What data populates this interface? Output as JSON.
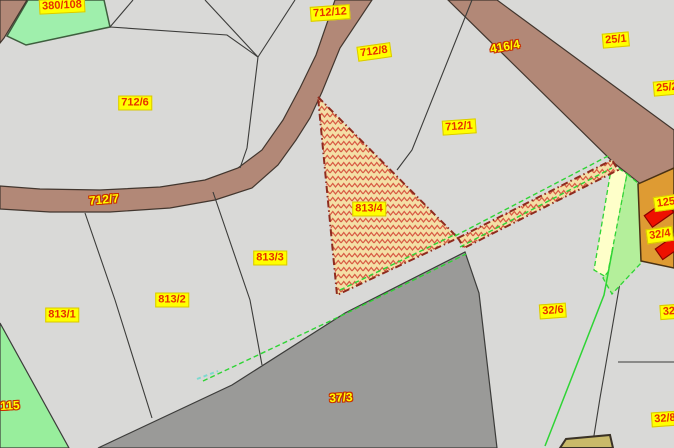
{
  "app": {
    "view": "cadastral-parcel-map"
  },
  "map": {
    "selected_parcel": "813/4",
    "colors": {
      "parcel_base": "#D9D9D7",
      "boundary_line": "#3C3C3A",
      "road_brown": "#B28877",
      "road_gray": "#9A9A98",
      "selection_fill": "#F4DFA6",
      "selection_hatch": "#D85C45",
      "selection_border": "#8F2B1E",
      "green_parcel": "#9FEFAC",
      "green_parcel_2": "#98EE9C",
      "light_green_parcel": "#B4EF9B",
      "pale_yellow_parcel": "#FEFFC9",
      "orange_parcel": "#DE9B33",
      "building_red": "#EE1100",
      "vegetation_green": "#2FD435",
      "water_dash_cyan": "#7ED9CF",
      "label_box_bg": "#FFFF00",
      "label_text_red": "#E63000",
      "label_text_yellow": "#FFFF00"
    },
    "labels": [
      {
        "text": "380/108",
        "x": 62,
        "y": 6,
        "style": "box",
        "rot": -3
      },
      {
        "text": "712/12",
        "x": 330,
        "y": 13,
        "style": "box",
        "rot": -4
      },
      {
        "text": "712/8",
        "x": 374,
        "y": 52,
        "style": "box",
        "rot": -8
      },
      {
        "text": "416/4",
        "x": 505,
        "y": 47,
        "style": "outline",
        "rot": -10
      },
      {
        "text": "25/1",
        "x": 616,
        "y": 40,
        "style": "box",
        "rot": -5
      },
      {
        "text": "25/2",
        "x": 667,
        "y": 88,
        "style": "box",
        "rot": -5
      },
      {
        "text": "712/6",
        "x": 135,
        "y": 103,
        "style": "box",
        "rot": 0
      },
      {
        "text": "712/1",
        "x": 459,
        "y": 127,
        "style": "box",
        "rot": -4
      },
      {
        "text": "712/7",
        "x": 104,
        "y": 200,
        "style": "outline",
        "rot": -5
      },
      {
        "text": "813/4",
        "x": 369,
        "y": 209,
        "style": "box",
        "rot": 0
      },
      {
        "text": "125",
        "x": 666,
        "y": 203,
        "style": "box",
        "rot": -8
      },
      {
        "text": "32/4",
        "x": 660,
        "y": 235,
        "style": "box",
        "rot": -8
      },
      {
        "text": "813/3",
        "x": 270,
        "y": 258,
        "style": "box",
        "rot": 0
      },
      {
        "text": "813/2",
        "x": 172,
        "y": 300,
        "style": "box",
        "rot": 0
      },
      {
        "text": "813/1",
        "x": 62,
        "y": 315,
        "style": "box",
        "rot": 0
      },
      {
        "text": "32/6",
        "x": 553,
        "y": 311,
        "style": "box",
        "rot": -4
      },
      {
        "text": "32",
        "x": 669,
        "y": 312,
        "style": "box",
        "rot": -4
      },
      {
        "text": "37/3",
        "x": 341,
        "y": 398,
        "style": "outline",
        "rot": -3
      },
      {
        "text": "115",
        "x": 10,
        "y": 406,
        "style": "outline",
        "rot": -3
      },
      {
        "text": "32/8",
        "x": 665,
        "y": 419,
        "style": "box",
        "rot": -4
      }
    ]
  }
}
